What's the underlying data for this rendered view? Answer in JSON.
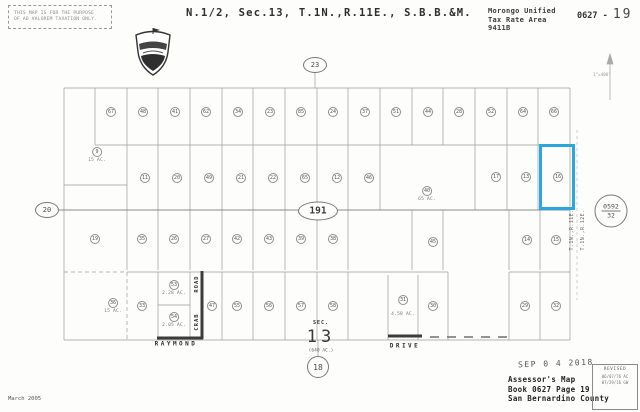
{
  "header": {
    "stamp_line1": "THIS MAP IS FOR THE PURPOSE",
    "stamp_line2": "OF AD VALOREM TAXATION ONLY.",
    "title": "N.1/2, Sec.13, T.1N.,R.11E., S.B.B.&M.",
    "tax_area": [
      "Morongo Unified",
      "Tax Rate Area",
      "9411B"
    ],
    "book_prefix": "0627 -",
    "page_number": "19",
    "scale": "1\"=400'"
  },
  "map": {
    "highway_marker": "191",
    "adjacent_pages": {
      "top": "23",
      "left": "20",
      "bottom": "18"
    },
    "ref_circle": {
      "top": "0592",
      "bottom": "32"
    },
    "township_west": "T.1N.,R.11E.",
    "township_east": "T.1N.,R.12E.",
    "roads": {
      "raymond": "RAYMOND",
      "drive": "DRIVE",
      "crab_upper": "ROAD",
      "crab_lower": "CRAB"
    },
    "section": {
      "label": "SEC.",
      "number": "13",
      "area": "(640 AC.)"
    },
    "parcels": [
      {
        "n": "67",
        "x": 111,
        "y": 112
      },
      {
        "n": "48",
        "x": 143,
        "y": 112
      },
      {
        "n": "41",
        "x": 175,
        "y": 112
      },
      {
        "n": "62",
        "x": 206,
        "y": 112
      },
      {
        "n": "34",
        "x": 238,
        "y": 112
      },
      {
        "n": "23",
        "x": 270,
        "y": 112
      },
      {
        "n": "85",
        "x": 301,
        "y": 112
      },
      {
        "n": "24",
        "x": 333,
        "y": 112
      },
      {
        "n": "37",
        "x": 365,
        "y": 112
      },
      {
        "n": "51",
        "x": 396,
        "y": 112
      },
      {
        "n": "44",
        "x": 428,
        "y": 112
      },
      {
        "n": "28",
        "x": 459,
        "y": 112
      },
      {
        "n": "52",
        "x": 491,
        "y": 112
      },
      {
        "n": "64",
        "x": 523,
        "y": 112
      },
      {
        "n": "66",
        "x": 554,
        "y": 112
      },
      {
        "n": "9",
        "x": 97,
        "y": 155,
        "area": "15 AC."
      },
      {
        "n": "11",
        "x": 145,
        "y": 178
      },
      {
        "n": "20",
        "x": 177,
        "y": 178
      },
      {
        "n": "49",
        "x": 209,
        "y": 178
      },
      {
        "n": "21",
        "x": 241,
        "y": 178
      },
      {
        "n": "22",
        "x": 273,
        "y": 178
      },
      {
        "n": "65",
        "x": 305,
        "y": 178
      },
      {
        "n": "12",
        "x": 337,
        "y": 178
      },
      {
        "n": "46",
        "x": 369,
        "y": 178
      },
      {
        "n": "40",
        "x": 427,
        "y": 194,
        "area": "65 AC."
      },
      {
        "n": "17",
        "x": 496,
        "y": 177
      },
      {
        "n": "13",
        "x": 526,
        "y": 177
      },
      {
        "n": "16",
        "x": 558,
        "y": 177
      },
      {
        "n": "19",
        "x": 95,
        "y": 239
      },
      {
        "n": "35",
        "x": 142,
        "y": 239
      },
      {
        "n": "26",
        "x": 174,
        "y": 239
      },
      {
        "n": "27",
        "x": 206,
        "y": 239
      },
      {
        "n": "42",
        "x": 237,
        "y": 239
      },
      {
        "n": "43",
        "x": 269,
        "y": 239
      },
      {
        "n": "39",
        "x": 301,
        "y": 239
      },
      {
        "n": "38",
        "x": 333,
        "y": 239
      },
      {
        "n": "45",
        "x": 433,
        "y": 242
      },
      {
        "n": "14",
        "x": 527,
        "y": 240
      },
      {
        "n": "15",
        "x": 556,
        "y": 240
      },
      {
        "n": "36",
        "x": 113,
        "y": 306,
        "area": "15 AC."
      },
      {
        "n": "33",
        "x": 142,
        "y": 306
      },
      {
        "n": "53",
        "x": 174,
        "y": 288,
        "area": "2.28 AC."
      },
      {
        "n": "54",
        "x": 174,
        "y": 320,
        "area": "2.05 AC."
      },
      {
        "n": "47",
        "x": 212,
        "y": 306
      },
      {
        "n": "55",
        "x": 237,
        "y": 306
      },
      {
        "n": "56",
        "x": 269,
        "y": 306
      },
      {
        "n": "57",
        "x": 301,
        "y": 306
      },
      {
        "n": "58",
        "x": 333,
        "y": 306
      },
      {
        "n": "31",
        "x": 403,
        "y": 306,
        "area": "4.58 AC.",
        "gap": 7
      },
      {
        "n": "30",
        "x": 433,
        "y": 306
      },
      {
        "n": "29",
        "x": 525,
        "y": 306
      },
      {
        "n": "32",
        "x": 556,
        "y": 306
      }
    ]
  },
  "footer": {
    "map_date": "March 2005",
    "recorded_stamp": "SEP 0 4 2018",
    "assessor": [
      "Assessor's Map",
      "Book 0627 Page 19",
      "San Bernardino County"
    ],
    "revised": {
      "title": "REVISED",
      "entries": [
        "06/07/76 AC",
        "07/29/16 GW"
      ]
    }
  }
}
